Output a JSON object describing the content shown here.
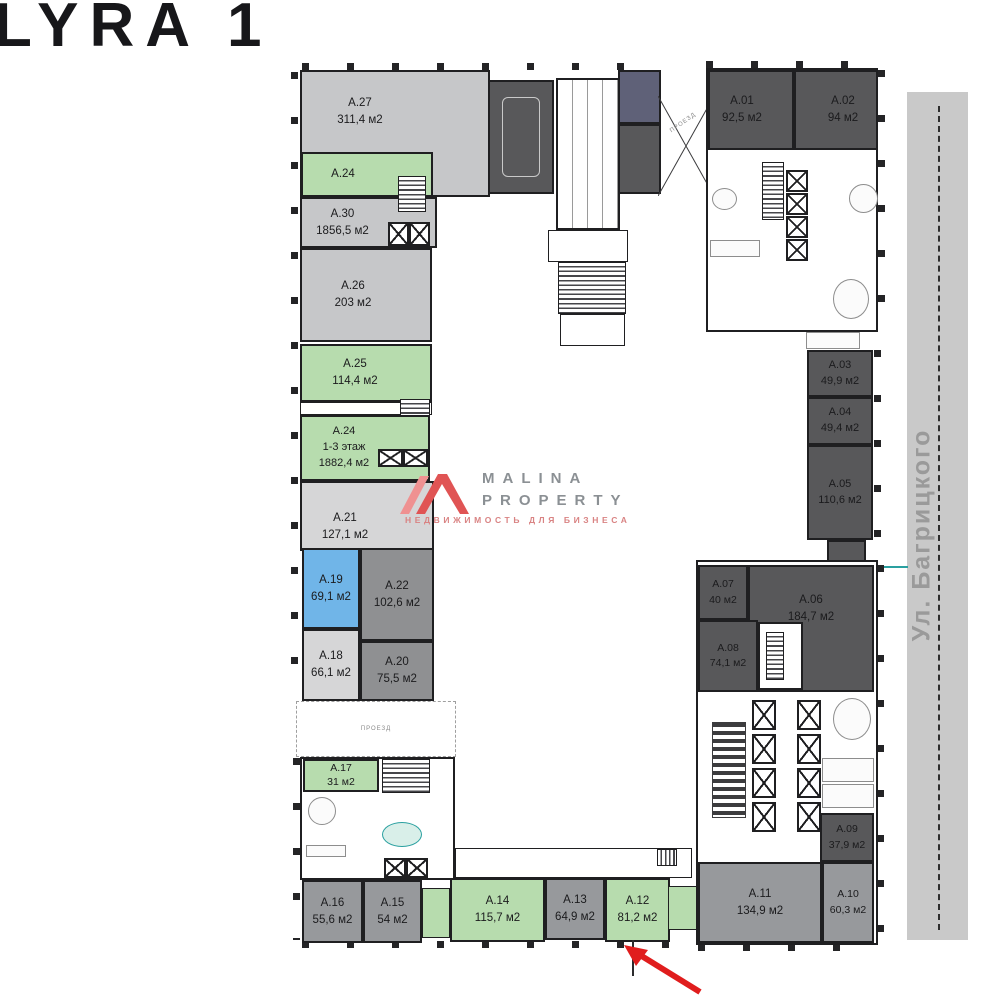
{
  "title": "LYRA 1",
  "street": {
    "label": "Ул. Багрицкого"
  },
  "watermark": {
    "brand_line1": "MALINA",
    "brand_line2": "PROPERTY",
    "subtitle": "НЕДВИЖИМОСТЬ ДЛЯ БИЗНЕСА"
  },
  "labels": {
    "passage": "ПРОЕЗД",
    "driveway": "ПРОЕЗД"
  },
  "colors": {
    "green": "#b7dcae",
    "light_gray": "#c6c7c9",
    "gray": "#97999c",
    "mid_gray": "#8f9092",
    "lighter_gray": "#d6d6d7",
    "dark": "#58585a",
    "navy": "#5f6178",
    "blue": "#70b5e8",
    "street": "#c9c9c9",
    "arrow_red": "#e01d1d",
    "teal": "#2aa0a0",
    "watermark_text": "#8b9094",
    "watermark_red": "#d98383"
  },
  "units": {
    "a27": {
      "id": "A.27",
      "area": "311,4 м2"
    },
    "a24_strip": {
      "id": "A.24"
    },
    "a30": {
      "id": "A.30",
      "area": "1856,5 м2"
    },
    "a26": {
      "id": "A.26",
      "area": "203 м2"
    },
    "a25": {
      "id": "A.25",
      "area": "114,4 м2"
    },
    "a24": {
      "id": "A.24",
      "floors": "1-3 этаж",
      "area": "1882,4 м2"
    },
    "a21": {
      "id": "A.21",
      "area": "127,1 м2"
    },
    "a19": {
      "id": "A.19",
      "area": "69,1 м2"
    },
    "a22": {
      "id": "A.22",
      "area": "102,6 м2"
    },
    "a18": {
      "id": "A.18",
      "area": "66,1 м2"
    },
    "a20": {
      "id": "A.20",
      "area": "75,5 м2"
    },
    "a17": {
      "id": "A.17",
      "area": "31 м2"
    },
    "a16": {
      "id": "A.16",
      "area": "55,6 м2"
    },
    "a15": {
      "id": "A.15",
      "area": "54 м2"
    },
    "a14": {
      "id": "A.14",
      "area": "115,7 м2"
    },
    "a13": {
      "id": "A.13",
      "area": "64,9 м2"
    },
    "a12": {
      "id": "A.12",
      "area": "81,2 м2"
    },
    "a11": {
      "id": "A.11",
      "area": "134,9 м2"
    },
    "a10": {
      "id": "A.10",
      "area": "60,3 м2"
    },
    "a09": {
      "id": "A.09",
      "area": "37,9 м2"
    },
    "a08": {
      "id": "A.08",
      "area": "74,1 м2"
    },
    "a07": {
      "id": "A.07",
      "area": "40 м2"
    },
    "a06": {
      "id": "A.06",
      "area": "184,7 м2"
    },
    "a05": {
      "id": "A.05",
      "area": "110,6 м2"
    },
    "a04": {
      "id": "A.04",
      "area": "49,4 м2"
    },
    "a03": {
      "id": "A.03",
      "area": "49,9 м2"
    },
    "a02": {
      "id": "A.02",
      "area": "94 м2"
    },
    "a01": {
      "id": "A.01",
      "area": "92,5 м2"
    }
  }
}
